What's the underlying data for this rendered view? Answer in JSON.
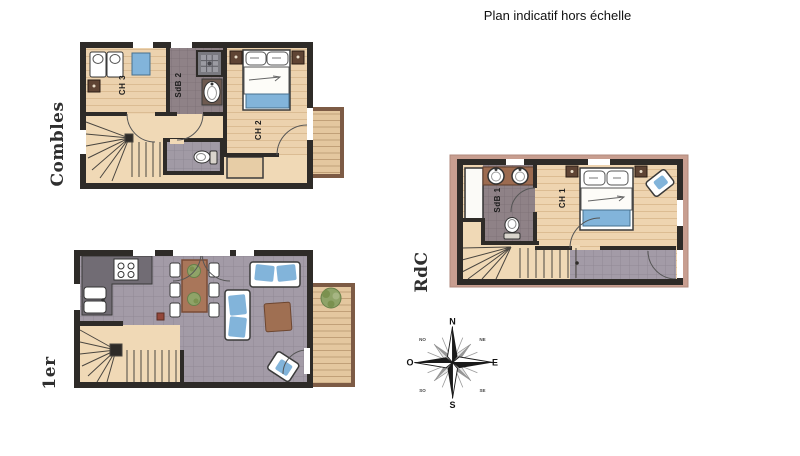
{
  "title": "Plan indicatif hors échelle",
  "floors": {
    "combles": {
      "label": "Combles",
      "rooms": {
        "ch3": "CH 3",
        "sdb2": "SdB 2",
        "ch2": "CH 2"
      }
    },
    "premier": {
      "label": "1er"
    },
    "rdc": {
      "label": "RdC",
      "rooms": {
        "sdb1": "SdB 1",
        "ch1": "CH 1"
      }
    }
  },
  "compass": {
    "n": "N",
    "ne": "NE",
    "e": "E",
    "se": "SE",
    "s": "S",
    "so": "SO",
    "o": "O",
    "no": "NO"
  },
  "colors": {
    "wall": "#2e2b28",
    "wood_floor": "#ecd2ae",
    "stair_floor": "#f0d9b6",
    "tile_floor": "#a39ba7",
    "bath_tile": "#8f8287",
    "textile_blue": "#82b4da",
    "furniture_brown": "#a9765a",
    "balcony_wood": "#e4c79f",
    "railing_brown": "#7d5b45",
    "rdc_band_pink": "#c89e90",
    "plant_green": "#8fa368"
  }
}
